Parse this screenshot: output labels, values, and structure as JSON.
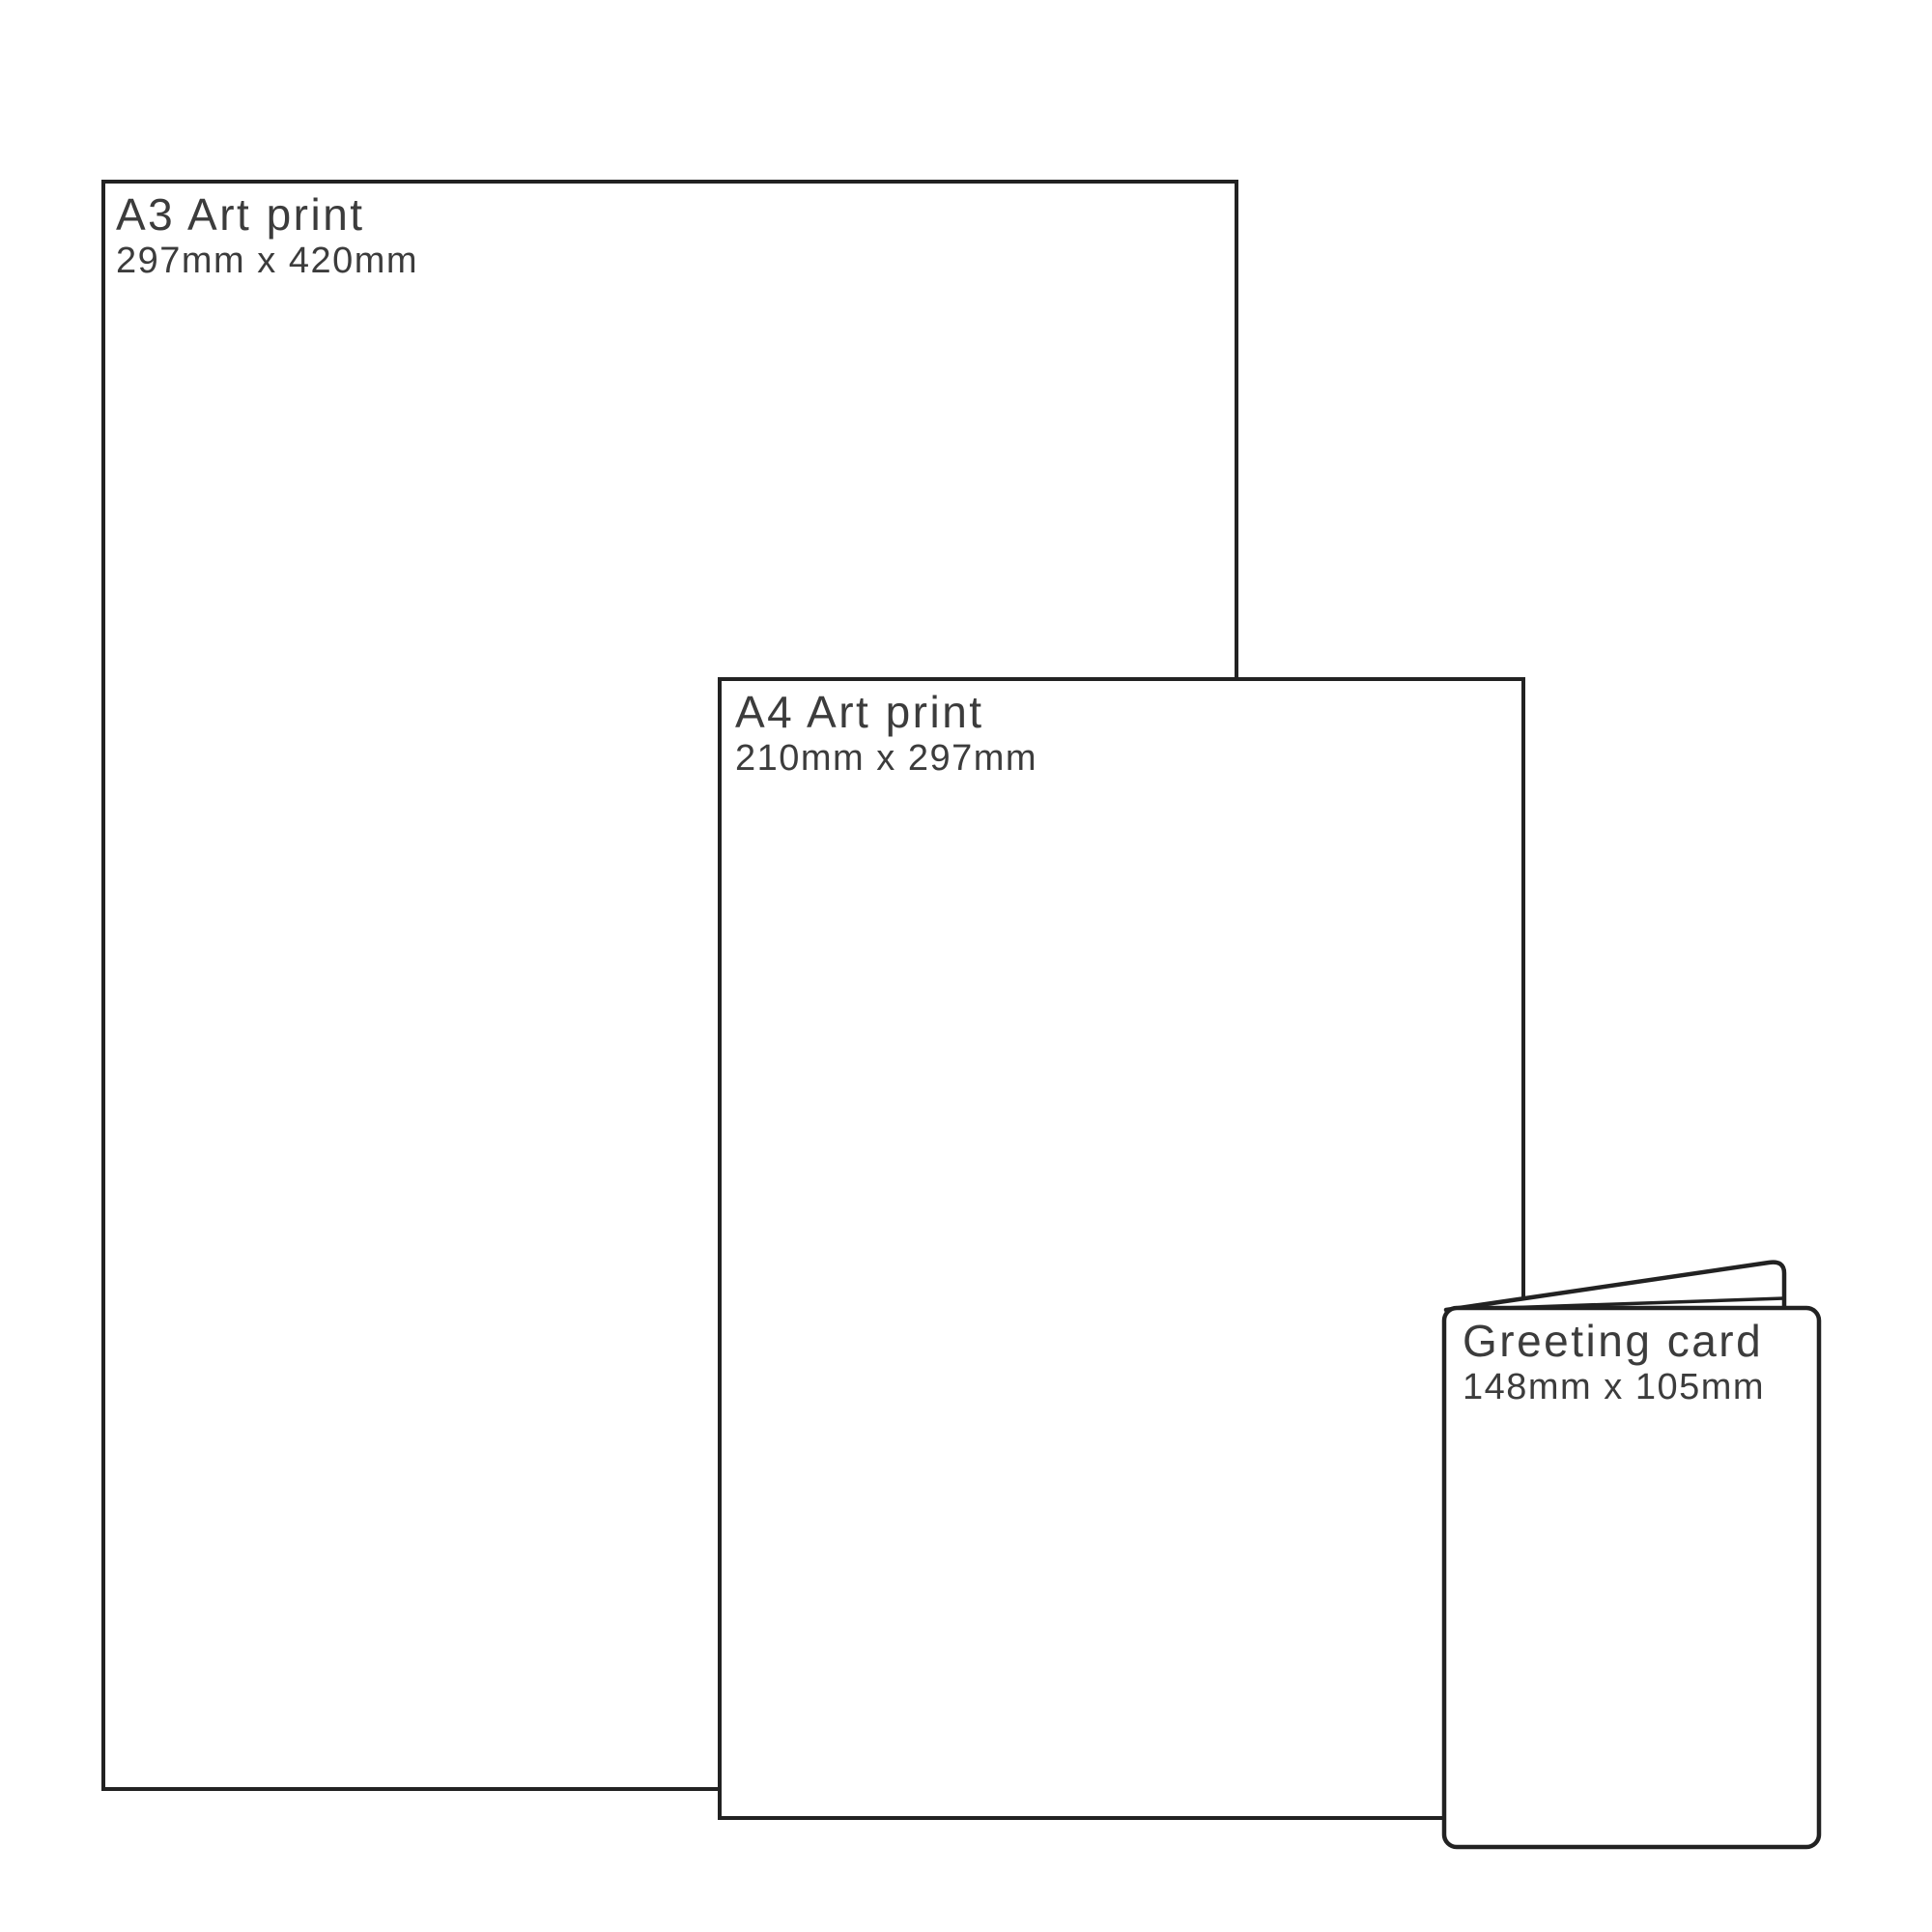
{
  "page": {
    "background_color": "#ffffff",
    "border_color": "#222222",
    "text_color": "#3c3c3c",
    "description": "Print size comparison diagram"
  },
  "items": [
    {
      "id": "a3-print",
      "title": "A3 Art print",
      "dimensions": "297mm x 420mm"
    },
    {
      "id": "a4-print",
      "title": "A4 Art print",
      "dimensions": "210mm x 297mm"
    },
    {
      "id": "greeting-card",
      "title": "Greeting card",
      "dimensions": "148mm x 105mm"
    }
  ]
}
